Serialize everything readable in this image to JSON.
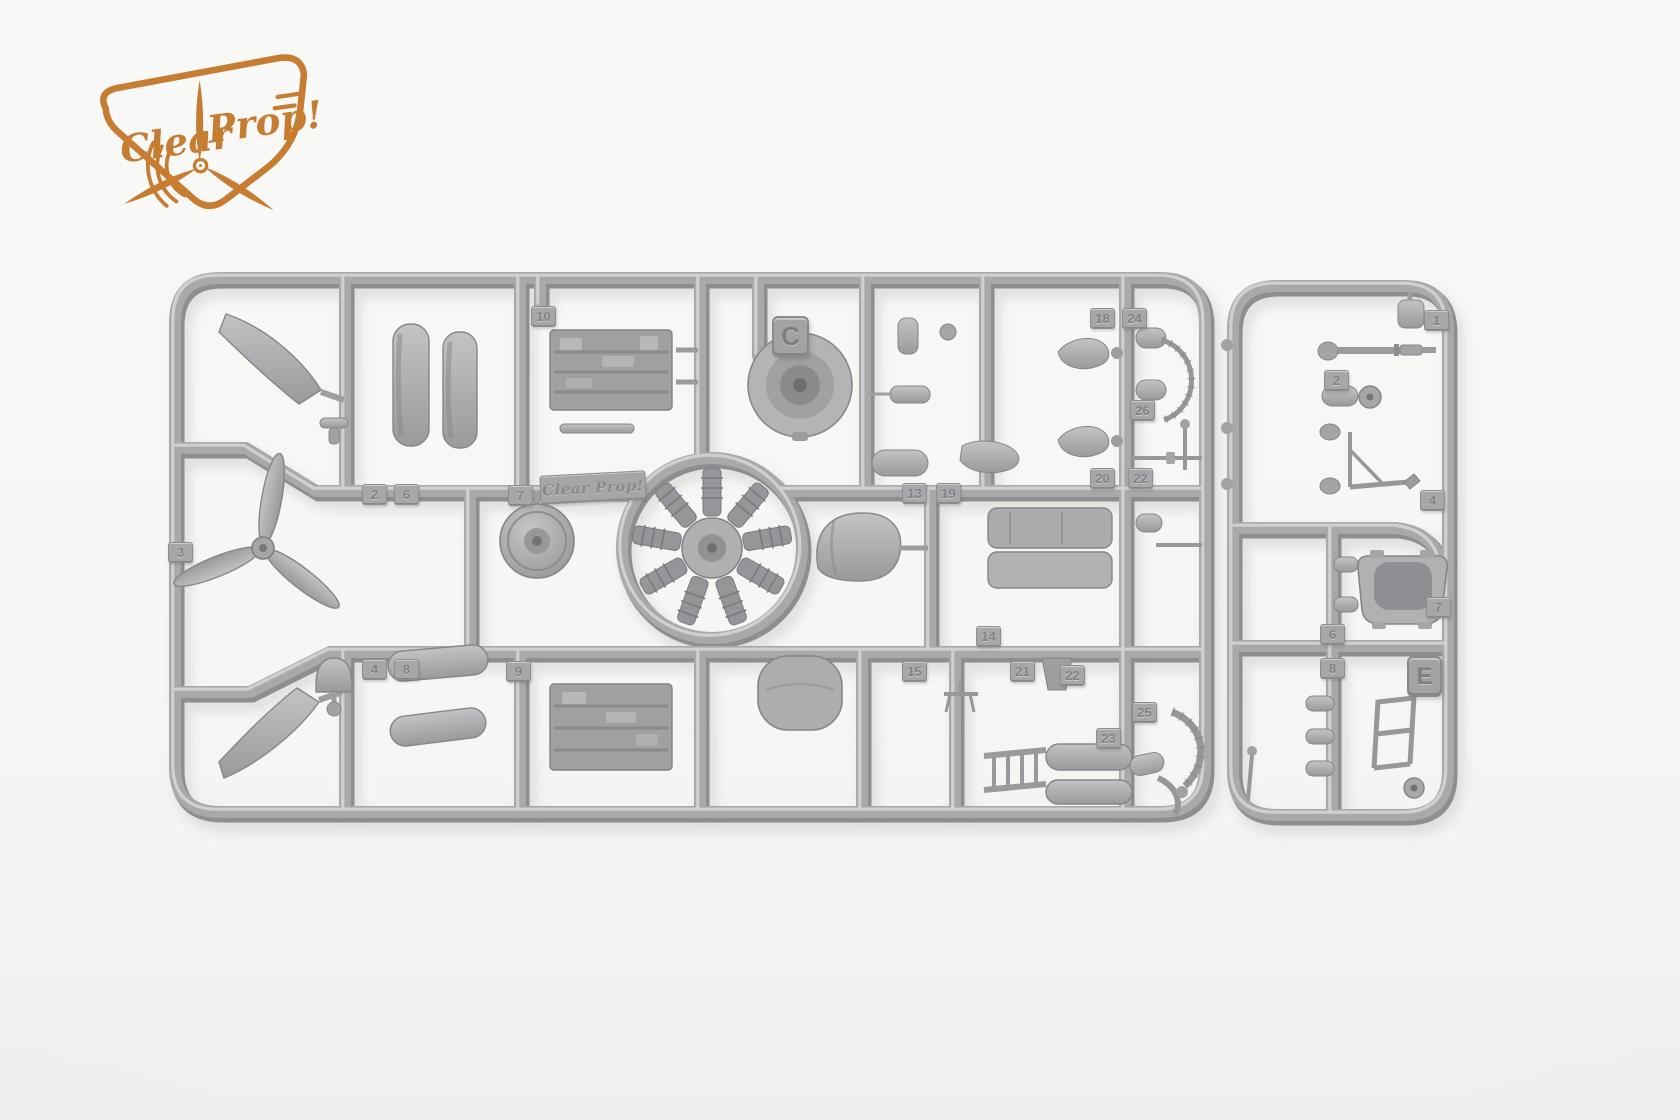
{
  "photo": {
    "background_color": "#f6f6f5",
    "plastic_color": "#a9a9ab",
    "description": "Two grey injection-moulded model kit sprues on a white background"
  },
  "logo": {
    "word1": "Clear",
    "word2": "Prop!",
    "color": "#c67c31"
  },
  "sprues": {
    "main": {
      "letter": "C",
      "molded_brand": "Clear Prop!",
      "part_tags": [
        {
          "label": "10",
          "x": 531,
          "y": 306
        },
        {
          "label": "2",
          "x": 362,
          "y": 484
        },
        {
          "label": "6",
          "x": 394,
          "y": 484
        },
        {
          "label": "7",
          "x": 508,
          "y": 485
        },
        {
          "label": "13",
          "x": 902,
          "y": 483
        },
        {
          "label": "19",
          "x": 936,
          "y": 483
        },
        {
          "label": "3",
          "x": 168,
          "y": 542
        },
        {
          "label": "18",
          "x": 1090,
          "y": 308
        },
        {
          "label": "24",
          "x": 1122,
          "y": 308
        },
        {
          "label": "26",
          "x": 1130,
          "y": 400
        },
        {
          "label": "20",
          "x": 1090,
          "y": 468
        },
        {
          "label": "22",
          "x": 1128,
          "y": 468
        },
        {
          "label": "14",
          "x": 976,
          "y": 626
        },
        {
          "label": "15",
          "x": 902,
          "y": 661
        },
        {
          "label": "21",
          "x": 1010,
          "y": 661
        },
        {
          "label": "22",
          "x": 1060,
          "y": 665
        },
        {
          "label": "25",
          "x": 1132,
          "y": 702
        },
        {
          "label": "23",
          "x": 1096,
          "y": 728
        },
        {
          "label": "4",
          "x": 362,
          "y": 659
        },
        {
          "label": "8",
          "x": 394,
          "y": 659
        },
        {
          "label": "9",
          "x": 506,
          "y": 661
        }
      ]
    },
    "small": {
      "letter": "E",
      "part_tags": [
        {
          "label": "1",
          "x": 1424,
          "y": 310
        },
        {
          "label": "2",
          "x": 1324,
          "y": 370
        },
        {
          "label": "4",
          "x": 1420,
          "y": 490
        },
        {
          "label": "7",
          "x": 1426,
          "y": 597
        },
        {
          "label": "6",
          "x": 1320,
          "y": 624
        },
        {
          "label": "8",
          "x": 1320,
          "y": 658
        }
      ]
    }
  }
}
